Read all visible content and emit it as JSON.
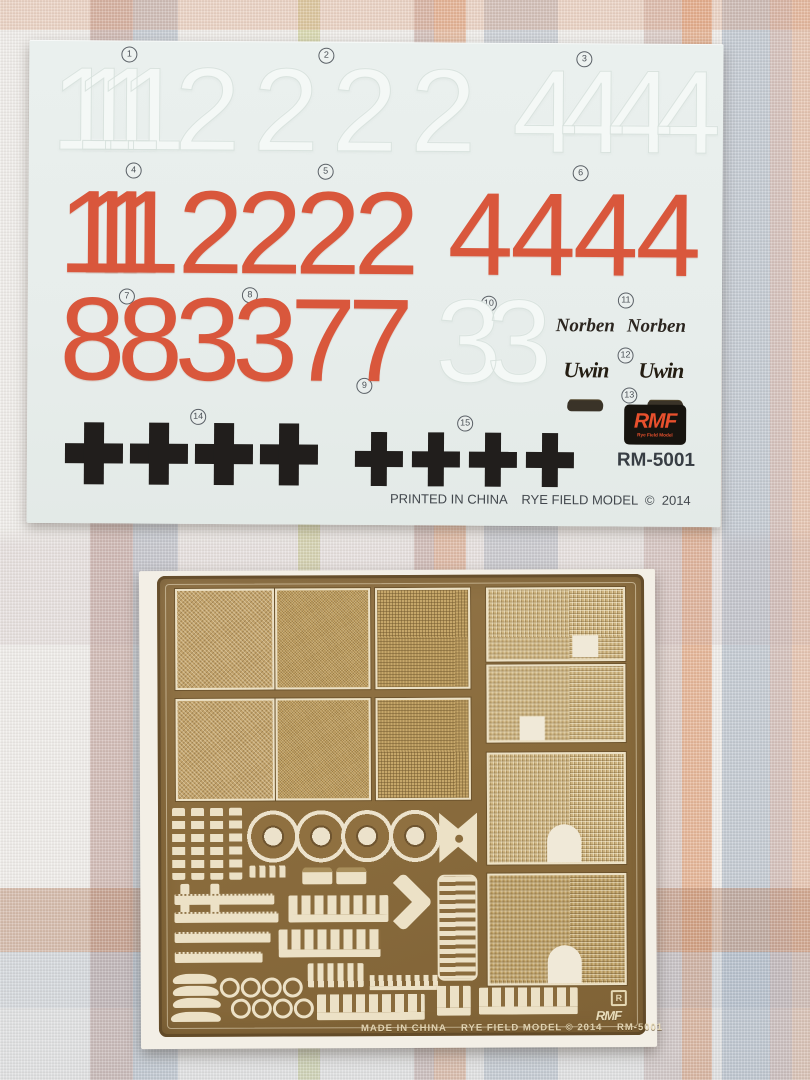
{
  "colors": {
    "decal_background": "#e8eeec",
    "decal_red": "#d9573c",
    "cross_black": "#211e1c",
    "logo_red": "#e8502d",
    "brass": "#8a6c3d",
    "brass_mesh": "#c3a46d",
    "etch_cream": "#ece1c6",
    "fabric_orange": "#de9467",
    "fabric_blue": "#98a8bc",
    "fabric_mauve": "#b68e86",
    "fabric_green": "#c6ca80"
  },
  "decal": {
    "callouts": [
      "1",
      "2",
      "3",
      "4",
      "5",
      "6",
      "7",
      "8",
      "9",
      "10",
      "11",
      "12",
      "13",
      "14",
      "15"
    ],
    "white_row": {
      "g1": "1111",
      "g2": "2222",
      "g3": "4444"
    },
    "red_row": {
      "g1": "1111",
      "g2": "2222",
      "g3": "4444"
    },
    "red_digits": "883377",
    "white_digits": "33",
    "names": {
      "n1": "Norben",
      "n2": "Norben",
      "n3": "Uwin",
      "n4": "Uwin"
    },
    "crosses": {
      "large_count": 4,
      "small_count": 4
    },
    "logo": {
      "main": "RMF",
      "sub": "Rye Field Model"
    },
    "code": "RM-5001",
    "footer": "PRINTED IN CHINA    RYE FIELD MODEL  ©  2014"
  },
  "pe": {
    "registered_mark": "R",
    "etched_logo": "RMF",
    "footer": "MADE IN CHINA    RYE FIELD MODEL © 2014    RM-5001"
  }
}
